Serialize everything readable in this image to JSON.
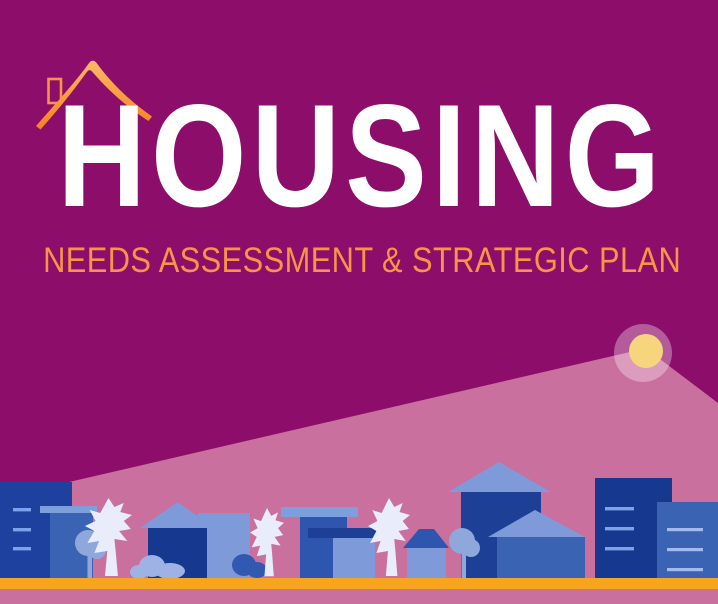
{
  "poster": {
    "title": "HOUSING",
    "subtitle": "NEEDS ASSESSMENT & STRATEGIC PLAN"
  },
  "icons": {
    "roof": "house-roof-icon",
    "sun": "sun-icon",
    "beam": "light-beam",
    "skyline": "city-skyline",
    "ground": "ground-road"
  },
  "palette": {
    "background": "#8d0e6a",
    "beam_pink": "#c9709e",
    "sun_yellow": "#f7d57c",
    "halo_white": "rgba(255,238,247,0.35)",
    "title_white": "#ffffff",
    "accent_orange": "#f79447",
    "roof_orange_light": "#fcb768",
    "roof_orange_dark": "#f58220",
    "ground_amber": "#f7a41e",
    "navy": "#16388f",
    "navy_deep": "#1d4096",
    "royal": "#1e409e",
    "royal_mid": "#2e56ae",
    "blue_mid": "#3b63b4",
    "steel": "#7e9ad8",
    "steel_cap": "#7da0dc",
    "tree_blue": "#8fa8dc",
    "bush_light": "#9fb2e4",
    "bush_royal": "#3159b2",
    "tree_pale": "#e9ecfb",
    "window_light": "#7da2e8",
    "window_pale": "#a3baee"
  }
}
